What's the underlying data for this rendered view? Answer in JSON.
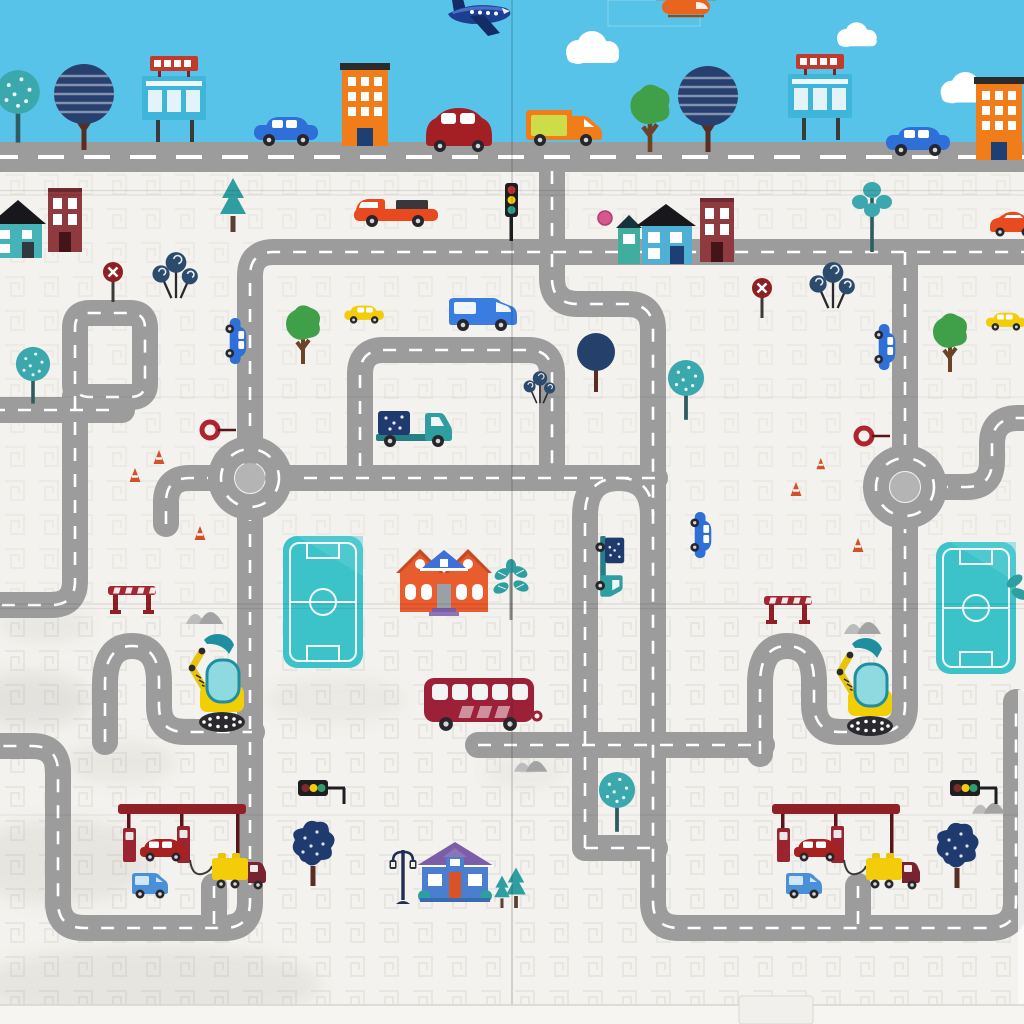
{
  "scene": {
    "kind": "photo of foldable kids play mat",
    "subject": "illustrated city road map for toy cars",
    "panels": 2,
    "visible_text": ""
  },
  "palette": {
    "sky": "#58c3e9",
    "mat_base": "#f3f2ee",
    "texture": "#dcd8d1",
    "road": "#9c9c9c",
    "road_dash": "#ffffff",
    "roundabout_center": "#b4b4b4",
    "pool_teal": "#3cc3c9",
    "canopy_red": "#8f2026",
    "building_orange": "#f07d1a",
    "building_maroon": "#8e3a3e",
    "house_teal": "#45b3b8",
    "house_blue_wall": "#4a7fd0",
    "roof_purple": "#7b5ea7",
    "roof_blue": "#3f6fd8",
    "bus_red": "#9c2038",
    "car_red": "#a8201f",
    "car_blue": "#2e6fd8",
    "car_yellow": "#f3cd0a",
    "van_orange": "#f07d1a",
    "truck_teal": "#2f9ea0",
    "tree_navy": "#27406e",
    "tree_teal": "#3aa8ad",
    "tree_green": "#3fa049",
    "sign_red": "#b02430",
    "excavator_yellow": "#f2cf05",
    "excavator_teal": "#1f8fa0",
    "cone_orange": "#d4502a"
  },
  "inventory": {
    "sky_band": {
      "clouds": 3,
      "airplane": "blue-airplane",
      "helicopter": "orange-helicopter",
      "billboards": 2,
      "orange_towers": 2,
      "trees": [
        "teal-bush-tree",
        "navy-striped-tree",
        "green-bush-tree",
        "navy-striped-tree"
      ],
      "cars_on_top_road": [
        "blue-car",
        "dark-red-beetle",
        "orange-van",
        "blue-car"
      ]
    },
    "map_area": {
      "roundabouts": 2,
      "swimming_pools": 2,
      "gas_stations": 2,
      "excavators": 2,
      "bus": 1,
      "houses": [
        "teal-rowhouse",
        "maroon-tower",
        "blue-mansion",
        "maroon-tower",
        "red-manor-house",
        "blue-cottage"
      ],
      "red_sports_car": 1,
      "red_pickup_truck": 1,
      "teal_flatbed_trucks": 2,
      "delivery_vans": 2,
      "yellow_cars": 2,
      "parked_vertical_cars": 3,
      "no_entry_signs": 2,
      "red_lollipop_signs": 2,
      "traffic_lights": 3,
      "street_lamp": 1,
      "barriers": 2,
      "traffic_cones": 6,
      "rock_mounds": 4,
      "street_trees": 14
    },
    "mat_features": {
      "fold_lines_horizontal": 4,
      "fold_line_vertical": 1,
      "bottom_edge_tab": 1
    }
  }
}
